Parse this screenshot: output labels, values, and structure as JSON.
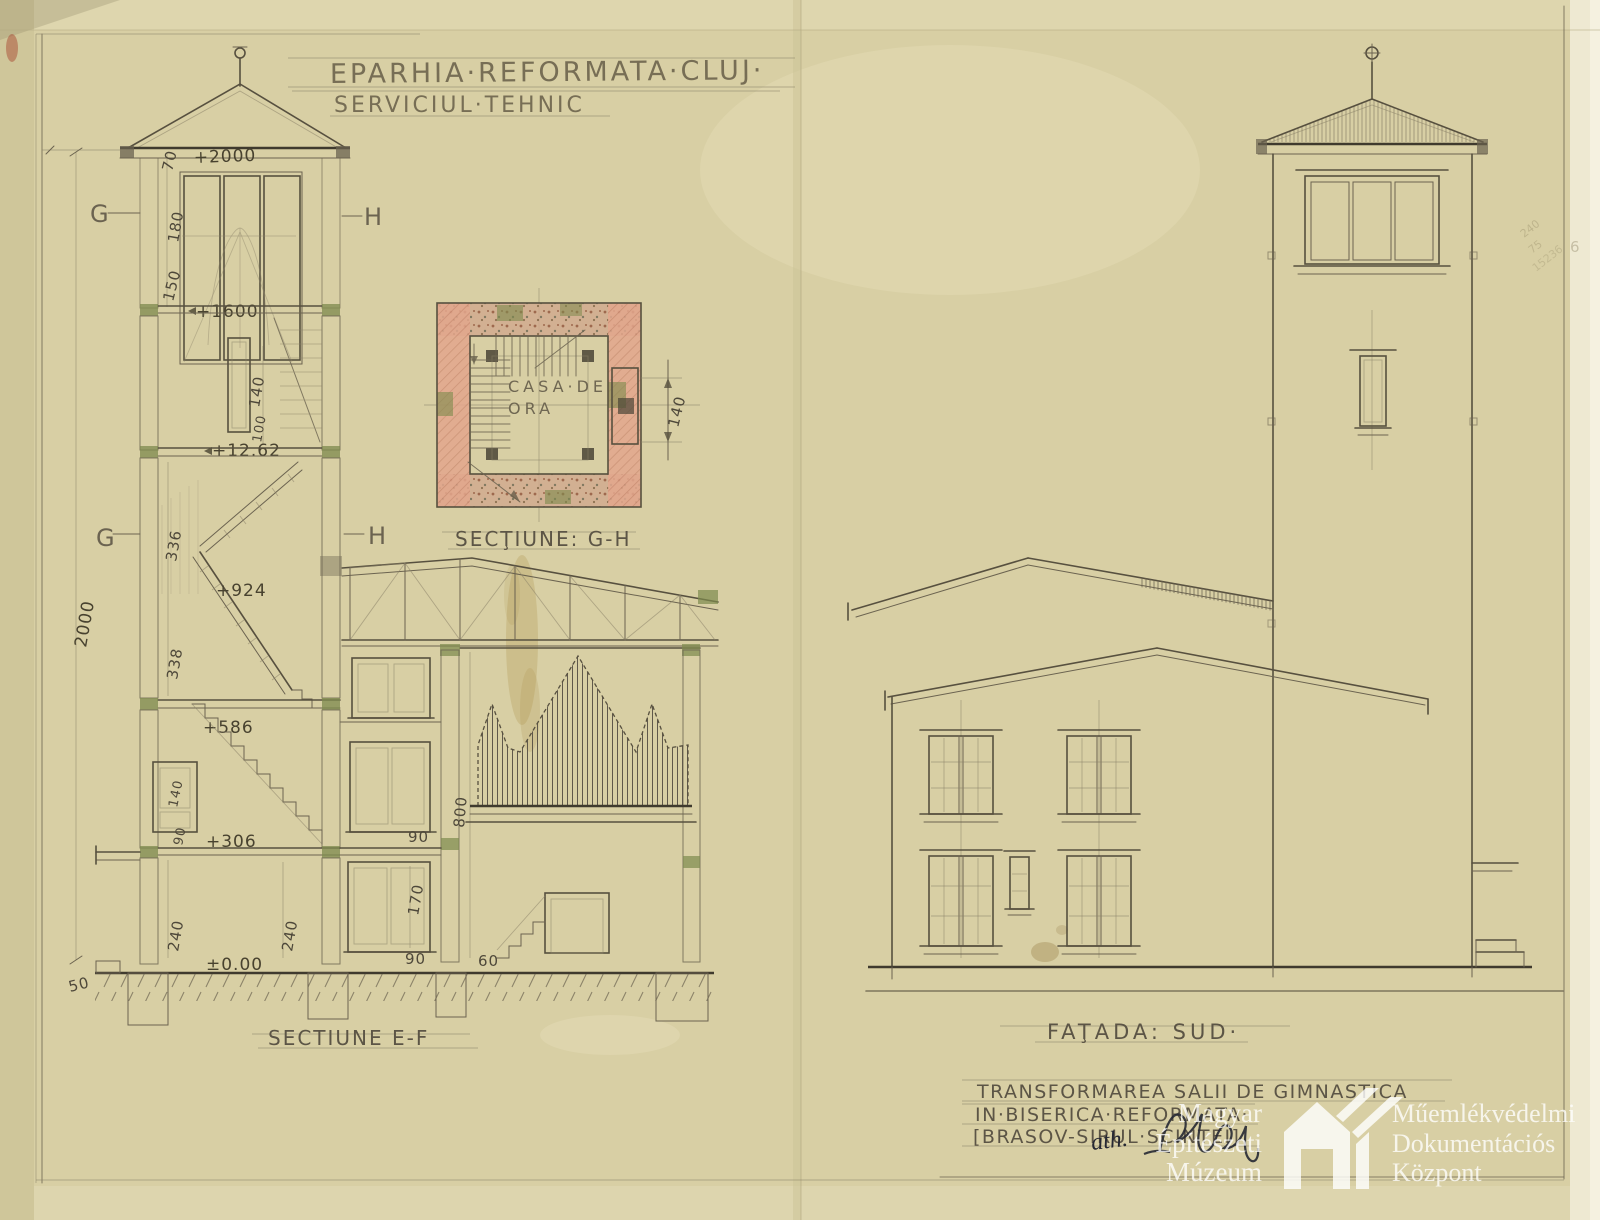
{
  "sheet": {
    "paper_color": "#d8cfa4",
    "pencil_color": "#57503f",
    "wall_pink": "#e2a68c",
    "timber_green": "#7d8a4d",
    "ink_color": "#262833",
    "watermark_color": "#ffffff"
  },
  "header": {
    "line1": "EPARHIA·REFORMATA·CLUJ·",
    "line2": "SERVICIUL·TEHNIC"
  },
  "section_ef": {
    "label": "SECTIUNE E-F",
    "marks": {
      "g": "G",
      "h": "H"
    },
    "levels": {
      "p2000": "+2000",
      "p1600": "+1600",
      "p1262": "+12.62",
      "p924": "+924",
      "p586": "+586",
      "p306": "+306",
      "zero": "±0.00"
    },
    "dims": {
      "d70": "70",
      "d180": "180",
      "d150": "150",
      "d338a": "338",
      "d140slot": "140",
      "d100": "100",
      "d336": "336",
      "d338b": "338",
      "d2000": "2000",
      "d140win": "140",
      "d90win": "90",
      "d240a": "240",
      "d240b": "240",
      "d50": "50",
      "d90a": "90",
      "d170": "170",
      "d90b": "90",
      "d800": "800",
      "d60": "60"
    }
  },
  "plan_gh": {
    "label": "SECŢIUNE: G-H",
    "room_line1": "CASA·DE",
    "room_line2": "ORA",
    "dim140": "140"
  },
  "facade_sud": {
    "label": "FAŢADA: SUD·"
  },
  "project": {
    "line1": "TRANSFORMAREA SALII DE GIMNASTICA",
    "line2": "IN·BISERICA·REFORMATA·",
    "line3": "[BRASOV-SIRUL·SCINTEI]",
    "signature": "ath."
  },
  "margin_notes": {
    "n1": "240",
    "n2": "75",
    "n3": "15236",
    "n4": "6"
  },
  "watermark": {
    "left": [
      "Magyar",
      "Építészeti",
      "Múzeum"
    ],
    "right": [
      "Műemlékvédelmi",
      "Dokumentációs",
      "Központ"
    ]
  }
}
